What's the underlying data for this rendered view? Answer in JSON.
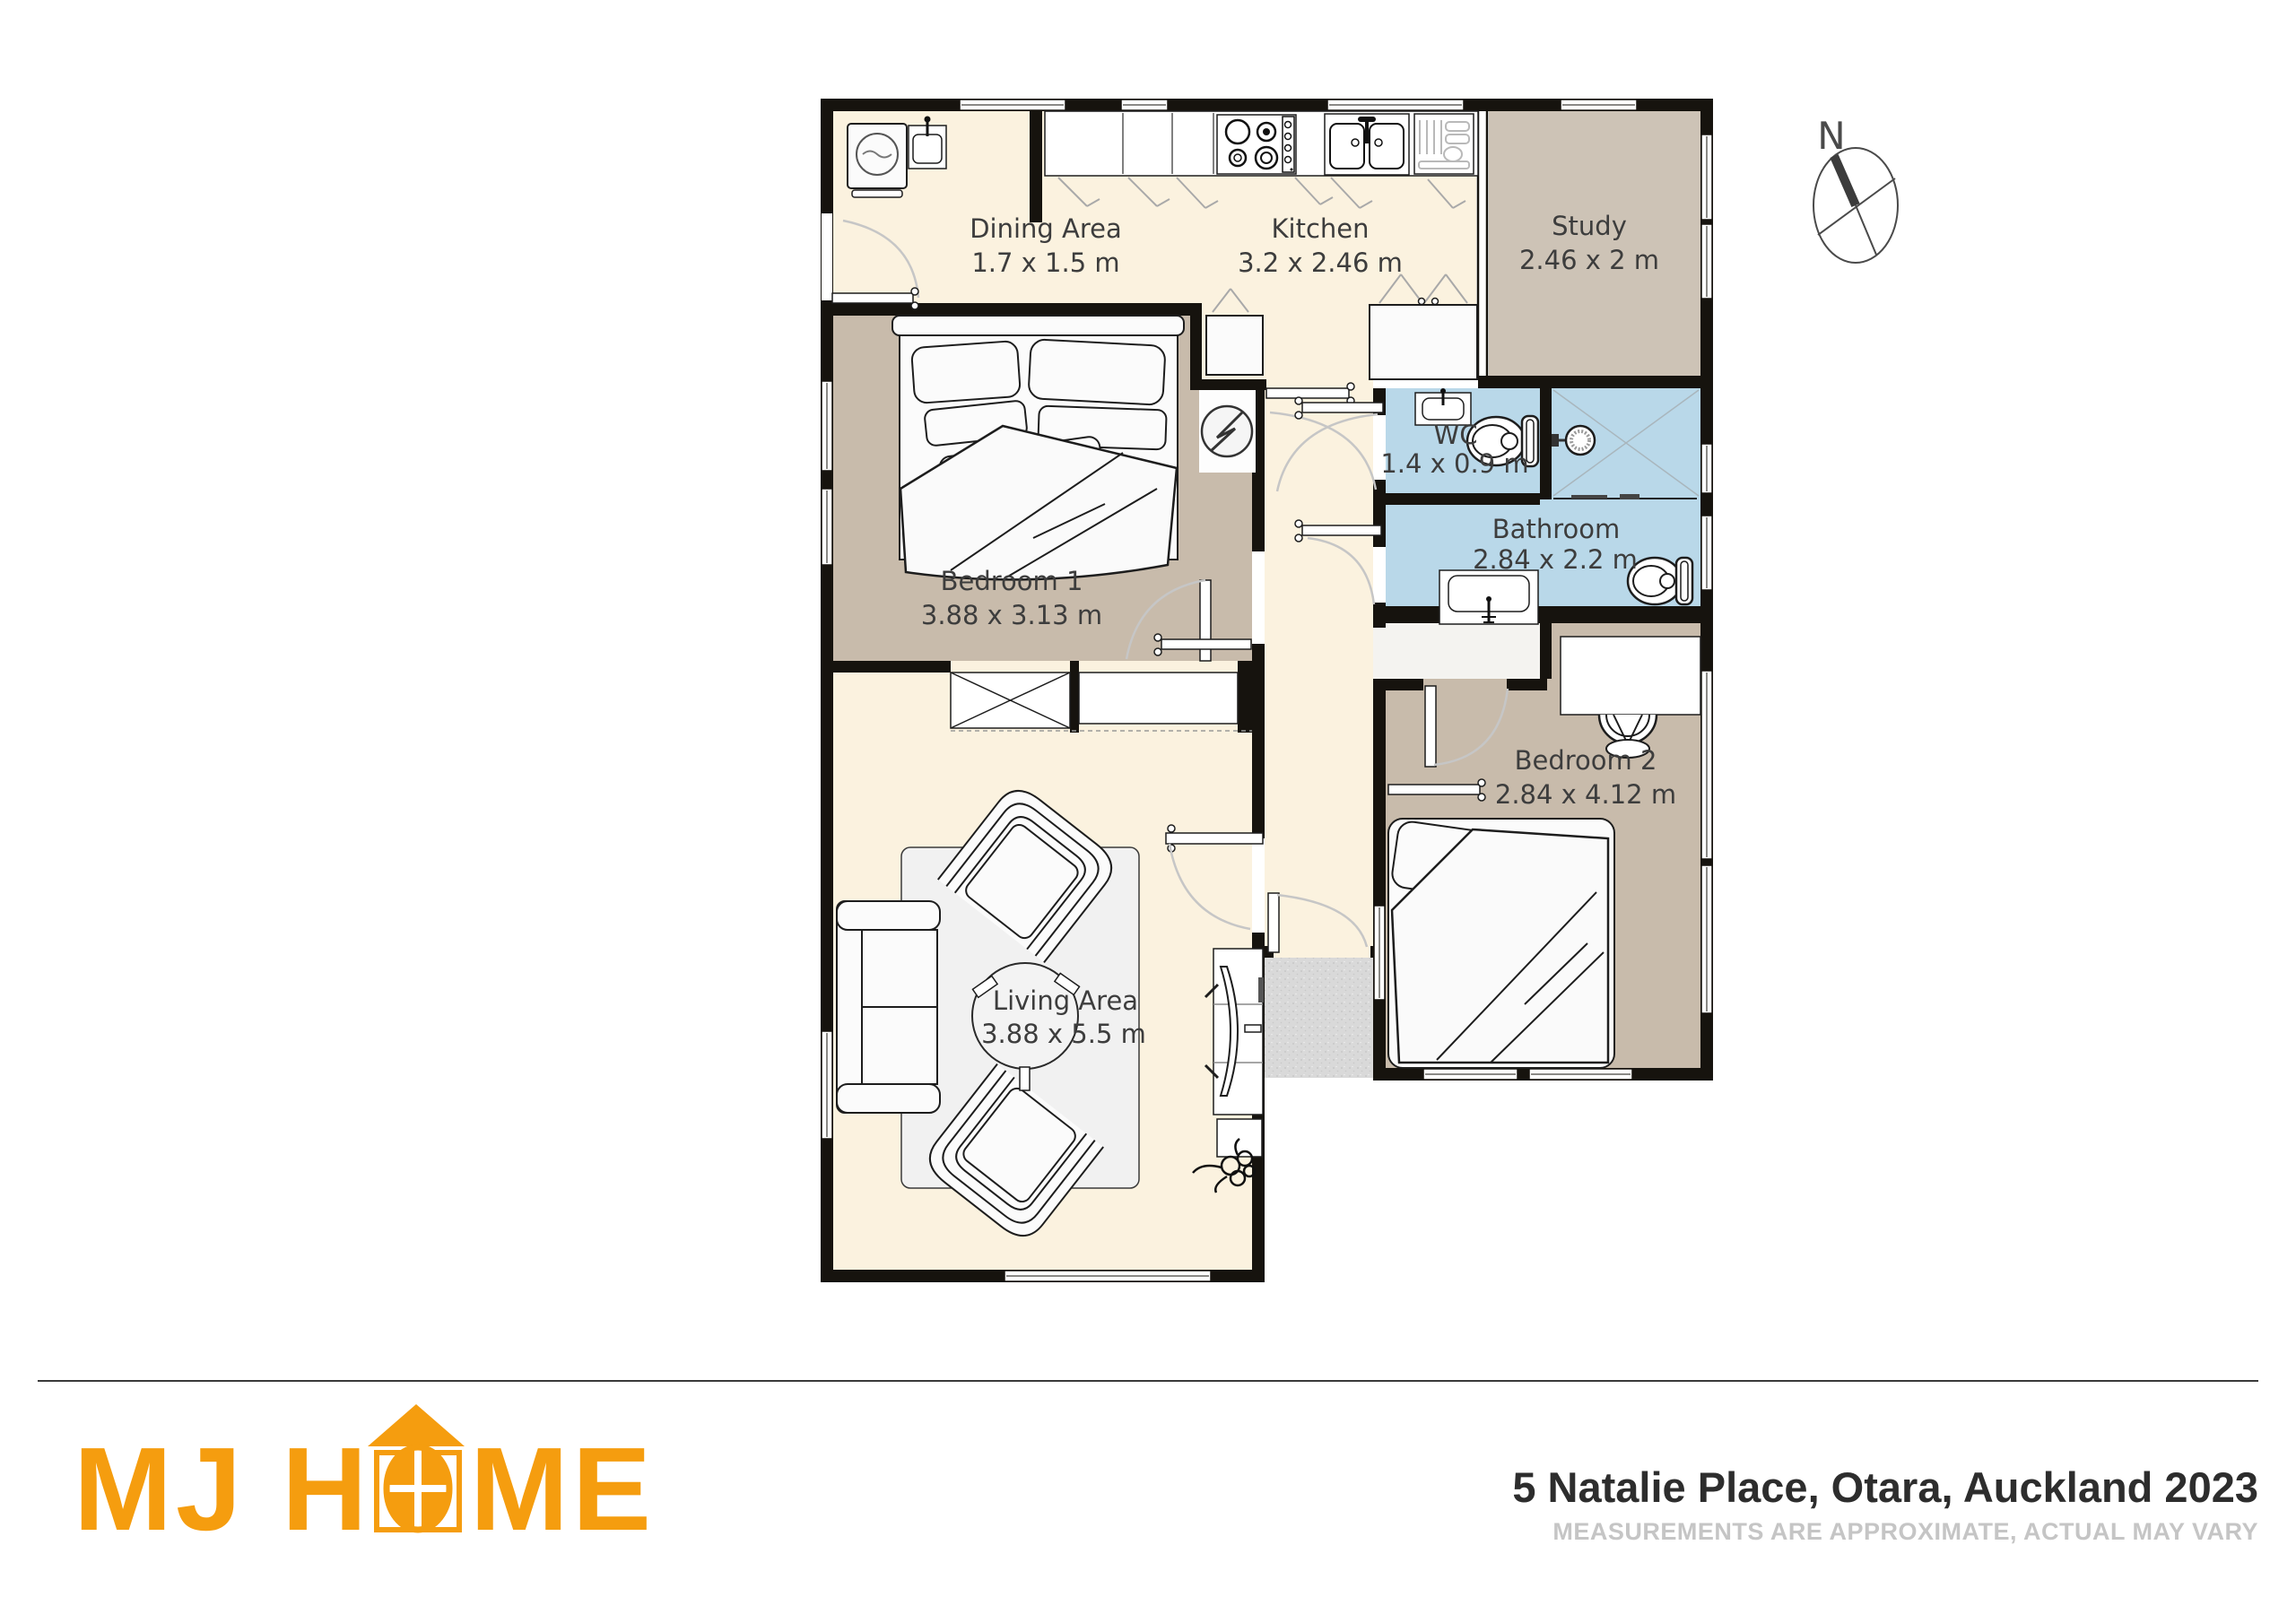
{
  "plan": {
    "rooms": [
      {
        "name": "Dining Area",
        "dims": "1.7 x 1.5 m"
      },
      {
        "name": "Kitchen",
        "dims": "3.2 x 2.46 m"
      },
      {
        "name": "Study",
        "dims": "2.46 x 2 m"
      },
      {
        "name": "Bedroom 1",
        "dims": "3.88 x 3.13 m"
      },
      {
        "name": "WC",
        "dims": "1.4 x 0.9 m"
      },
      {
        "name": "Bathroom",
        "dims": "2.84 x 2.2 m"
      },
      {
        "name": "Bedroom 2",
        "dims": "2.84 x 4.12 m"
      },
      {
        "name": "Living Area",
        "dims": "3.88 x 5.5 m"
      }
    ],
    "colors": {
      "floor_cream": "#FBF2DF",
      "room_taupe": "#C8BBAB",
      "study_taupe": "#CDC3B6",
      "wet_blue": "#B9D8E9",
      "porch_grey": "#D9D9D9",
      "wall_black": "#16130E",
      "label_grey": "#3D3D3D"
    }
  },
  "compass": {
    "north_label": "N"
  },
  "footer": {
    "brand": "MJ HOME",
    "brand_left": "MJ H",
    "brand_right": "ME",
    "brand_color": "#F59D0F",
    "address": "5 Natalie Place, Otara, Auckland 2023",
    "disclaimer": "MEASUREMENTS ARE APPROXIMATE, ACTUAL MAY VARY"
  }
}
